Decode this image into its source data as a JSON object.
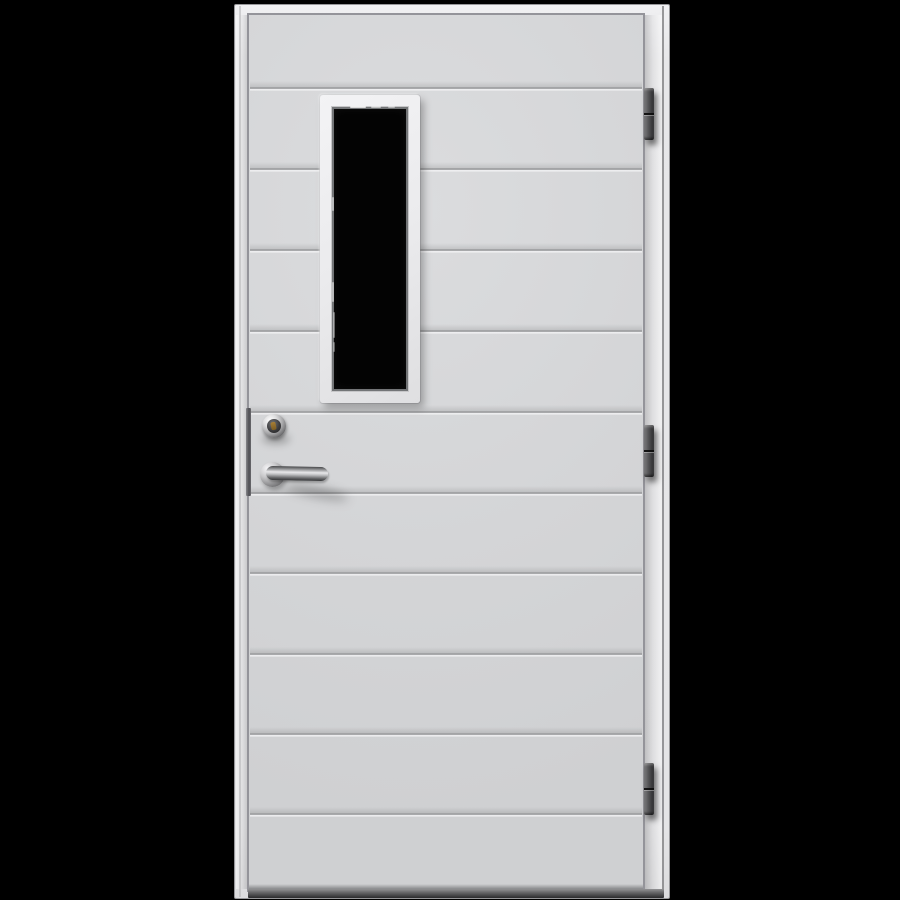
{
  "meta": {
    "domain": "natural-image",
    "description": "Studio product photo of a white exterior door with horizontal panel grooves, a tall narrow glazing window, a chrome lever handle with lock cylinder on the left, and three dark hinges on the right, set in a white frame on a black background."
  },
  "palette": {
    "background": "#000000",
    "frame_face": "#e8e8ea",
    "frame_edge": "#97979a",
    "leaf_face": "#d4d5d7",
    "groove_dark": "#a2a3a5",
    "groove_light": "#eff0f2",
    "window_trim": "#eeeef0",
    "glass": "#030303",
    "glazing_bead": "#737577",
    "chrome_light": "#f2f2f4",
    "chrome_dark": "#3a3b3d",
    "keyhole_gold": "#96742e",
    "hinge_dark": "#303032",
    "threshold_dark": "#2a2a2c"
  },
  "layout": {
    "stage": {
      "x": 0,
      "y": 0,
      "w": 900,
      "h": 900
    },
    "frame": {
      "x": 234,
      "y": 4,
      "w": 436,
      "h": 895
    },
    "frame_shade_left": {
      "x": 236,
      "y": 15,
      "w": 13,
      "h": 874
    },
    "frame_shade_right": {
      "x": 645,
      "y": 15,
      "w": 17,
      "h": 874
    },
    "reveal_left": {
      "x": 239,
      "y": 6,
      "w": 2,
      "h": 891
    },
    "reveal_right": {
      "x": 662,
      "y": 6,
      "w": 2,
      "h": 891
    },
    "leaf": {
      "x": 249,
      "y": 15,
      "w": 394,
      "h": 875
    },
    "grooves": {
      "x": 250,
      "w": 392,
      "h": 10,
      "ys": [
        88,
        169,
        250,
        331,
        412,
        493,
        573,
        654,
        734,
        814
      ]
    },
    "leaf_bottom_shadow": {
      "x": 249,
      "y": 884,
      "w": 394,
      "h": 6
    },
    "threshold": {
      "x": 248,
      "y": 889,
      "w": 416,
      "h": 9
    },
    "lock_edge": {
      "x": 246,
      "y": 408,
      "w": 5,
      "h": 88
    },
    "window": {
      "trim": {
        "x": 320,
        "y": 95,
        "w": 100,
        "h": 308
      },
      "glass": {
        "x": 332,
        "y": 107,
        "w": 76,
        "h": 284
      },
      "reflections": [
        {
          "x": 350,
          "y": 106,
          "w": 16,
          "h": 2,
          "o": 0.75
        },
        {
          "x": 371,
          "y": 106,
          "w": 10,
          "h": 2,
          "o": 0.55
        },
        {
          "x": 388,
          "y": 106,
          "w": 7,
          "h": 2,
          "o": 0.45
        },
        {
          "x": 332,
          "y": 197,
          "w": 2,
          "h": 14,
          "o": 0.5
        },
        {
          "x": 332,
          "y": 282,
          "w": 2,
          "h": 20,
          "o": 0.5
        },
        {
          "x": 333,
          "y": 312,
          "w": 2,
          "h": 26,
          "o": 0.4
        },
        {
          "x": 333,
          "y": 342,
          "w": 2,
          "h": 10,
          "o": 0.35
        }
      ]
    },
    "cylinder": {
      "shadow": {
        "x": 262,
        "y": 434,
        "w": 28,
        "h": 10
      },
      "ring": {
        "x": 262,
        "y": 414,
        "w": 24,
        "h": 24
      },
      "inner": {
        "x": 267,
        "y": 419,
        "w": 14,
        "h": 14
      },
      "keyhole": {
        "x": 271,
        "y": 422,
        "w": 5,
        "h": 8
      }
    },
    "handle": {
      "shadow": {
        "x": 283,
        "y": 486,
        "w": 66,
        "h": 12
      },
      "rose": {
        "x": 260,
        "y": 462,
        "w": 25,
        "h": 25
      },
      "lever": {
        "x": 266,
        "y": 466,
        "w": 62,
        "h": 14
      }
    },
    "hinges": {
      "x": 644,
      "w": 10,
      "h": 52,
      "ys": [
        88,
        425,
        763
      ],
      "names": [
        "hinge-top",
        "hinge-middle",
        "hinge-bottom"
      ]
    }
  }
}
